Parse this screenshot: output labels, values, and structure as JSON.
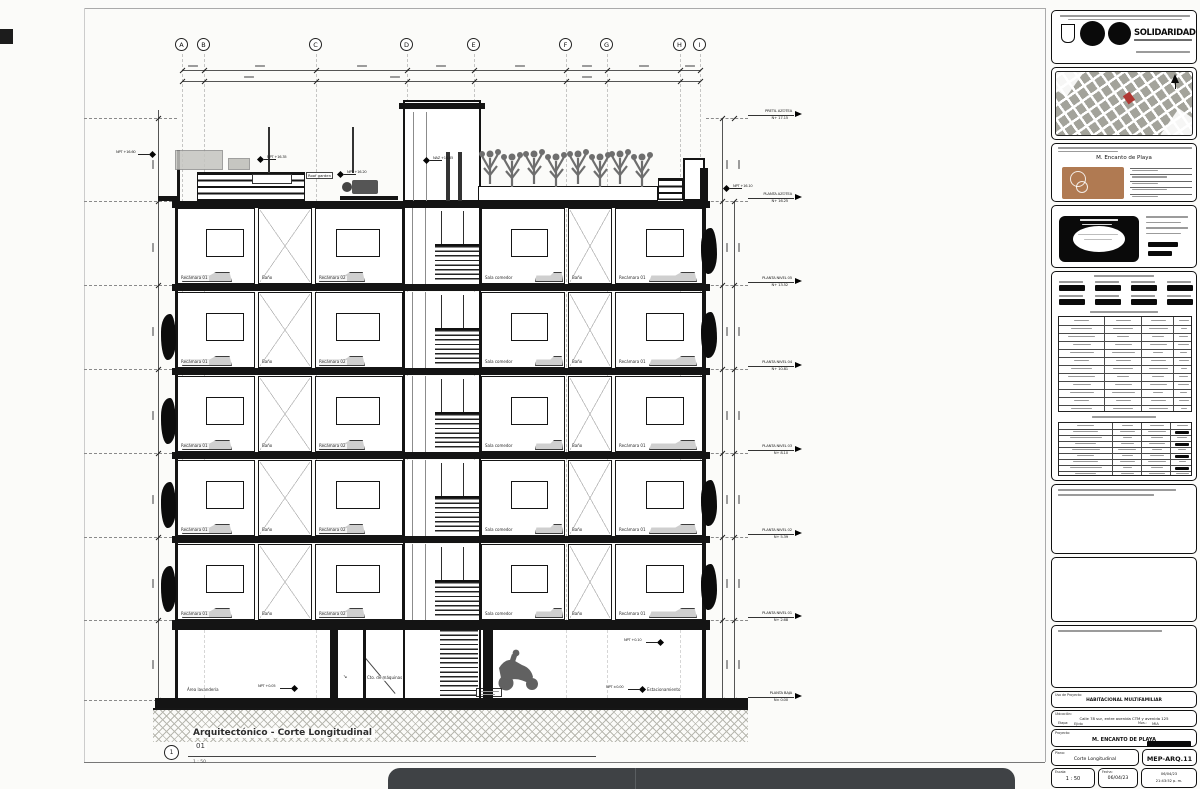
{
  "page": {
    "background": "#fbfbf9",
    "line_color": "#1a1a1a",
    "accent_red": "#b03732",
    "logo_brown": "#b07a52",
    "overlay_dark": "#3f4245"
  },
  "drawing": {
    "view_number": "1",
    "title": "Arquitectónico - Corte Longitudinal",
    "detail_number": "01",
    "scale_label": "1 : 50",
    "grid_bubbles": [
      {
        "label": "A",
        "x": 182
      },
      {
        "label": "B",
        "x": 204
      },
      {
        "label": "C",
        "x": 316
      },
      {
        "label": "D",
        "x": 407
      },
      {
        "label": "E",
        "x": 474
      },
      {
        "label": "F",
        "x": 566
      },
      {
        "label": "G",
        "x": 607
      },
      {
        "label": "H",
        "x": 680
      },
      {
        "label": "I",
        "x": 700
      }
    ],
    "levels": [
      {
        "name": "PRETIL AZOTEA",
        "elev": "N+ 17.15",
        "y": 118
      },
      {
        "name": "PLANTA AZOTEA",
        "elev": "N+ 16.25",
        "y": 201
      },
      {
        "name": "PLANTA NIVEL 05",
        "elev": "N+ 13.52",
        "y": 285
      },
      {
        "name": "PLANTA NIVEL 04",
        "elev": "N+ 10.81",
        "y": 369
      },
      {
        "name": "PLANTA NIVEL 03",
        "elev": "N+ 8.10",
        "y": 453
      },
      {
        "name": "PLANTA NIVEL 02",
        "elev": "N+ 5.39",
        "y": 537
      },
      {
        "name": "PLANTA NIVEL 01",
        "elev": "N+ 2.68",
        "y": 620
      },
      {
        "name": "PLANTA BAJA",
        "elev": "N± 0.00",
        "y": 700
      }
    ],
    "floor_tops": [
      208,
      292,
      376,
      460,
      544
    ],
    "typical_rooms": [
      {
        "label": "Recámara 01",
        "x": 177,
        "w": 78,
        "win": [
          28,
          38
        ],
        "bed": [
          4,
          50
        ]
      },
      {
        "label": "Baño",
        "x": 258,
        "w": 54,
        "brace": true
      },
      {
        "label": "Recámara 02",
        "x": 315,
        "w": 88,
        "win": [
          20,
          44
        ],
        "bed": [
          3,
          46
        ]
      },
      {
        "label": "Sala comedor",
        "x": 481,
        "w": 84,
        "win": [
          29,
          37
        ],
        "bed": [
          53,
          28
        ]
      },
      {
        "label": "Baño",
        "x": 568,
        "w": 44,
        "brace": true
      },
      {
        "label": "Recámara 01",
        "x": 615,
        "w": 88,
        "win": [
          30,
          38
        ],
        "bed": [
          33,
          48
        ]
      }
    ],
    "ground_labels": [
      {
        "t": "Área lavandería",
        "x": 186,
        "y": 688
      },
      {
        "t": "Cto. de máquinas",
        "x": 366,
        "y": 676
      },
      {
        "t": "Estacionamiento",
        "x": 646,
        "y": 688
      }
    ],
    "roof_label": "Roof garden",
    "npt_tags": [
      {
        "t": "NPT +16.60",
        "x": 150,
        "y": 152,
        "s": "l"
      },
      {
        "t": "NPT +16.35",
        "x": 258,
        "y": 157,
        "s": "r"
      },
      {
        "t": "NPT +16.20",
        "x": 338,
        "y": 172,
        "s": "r"
      },
      {
        "t": "NAZ +16.85",
        "x": 424,
        "y": 158,
        "s": "r"
      },
      {
        "t": "NPT +16.10",
        "x": 724,
        "y": 186,
        "s": "r"
      },
      {
        "t": "NPT +0.05",
        "x": 292,
        "y": 686,
        "s": "l"
      },
      {
        "t": "NPT +0.10",
        "x": 658,
        "y": 640,
        "s": "l"
      },
      {
        "t": "NPT ±0.00",
        "x": 640,
        "y": 687,
        "s": "l"
      }
    ]
  },
  "titleblock": {
    "header": {
      "brand": "SOLIDARIDAD"
    },
    "project": {
      "name": "M. Encanto de Playa"
    },
    "footer": {
      "uso_label": "Uso de Proyecto:",
      "uso": "HABITACIONAL MULTIFAMILIAR",
      "ubicacion_label": "Ubicación:",
      "ubicacion": "Calle 78 sur, entre avenida CTM y avenida 125",
      "etapa_label": "Etapa:",
      "etapa": "Ejido",
      "mza_label": "Mza.:",
      "mza": "MIA",
      "proyecto_label": "Proyecto:",
      "proyecto": "M. ENCANTO DE PLAYA",
      "plano_label": "Plano:",
      "plano": "Corte Longitudinal",
      "clave": "MEP-ARQ.11",
      "escala_label": "Escala:",
      "escala": "1 : 50",
      "fecha_label": "Fecha:",
      "fecha": "06/04/23",
      "hora": "21:43:52 p. m."
    }
  }
}
